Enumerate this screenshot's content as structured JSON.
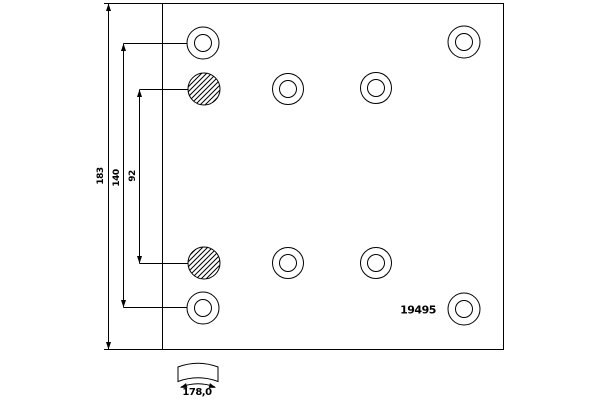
{
  "drawing": {
    "part_number": "19495",
    "dimensions": {
      "total_height": "183",
      "outer_hole_spacing": "140",
      "inner_hole_spacing": "92",
      "arc_width": "178,0"
    },
    "colors": {
      "line": "#000000",
      "background": "#ffffff"
    }
  }
}
